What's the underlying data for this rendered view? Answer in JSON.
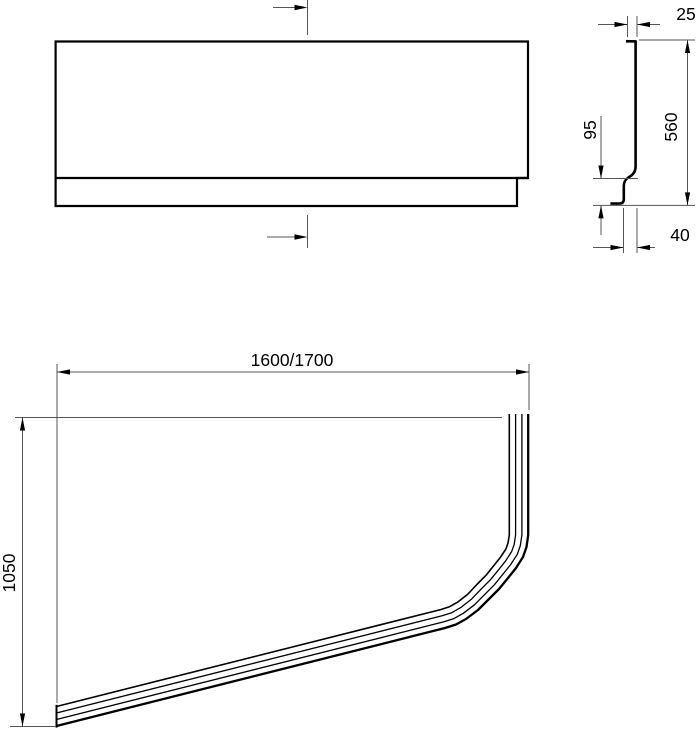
{
  "drawing": {
    "type": "technical-drawing",
    "subject": "corner-bath-front-panel",
    "background_color": "#ffffff",
    "outline_color": "#000000",
    "dim_line_color": "#555555",
    "views": {
      "front_elevation": {
        "description": "panel front view with centerline markers",
        "centerline_markers": 2
      },
      "side_profile": {
        "dims": {
          "top_thickness": "25",
          "total_height": "560",
          "plinth_height": "95",
          "bottom_offset": "40"
        }
      },
      "plan_view": {
        "dims": {
          "length": "1600/1700",
          "depth": "1050"
        }
      }
    }
  }
}
